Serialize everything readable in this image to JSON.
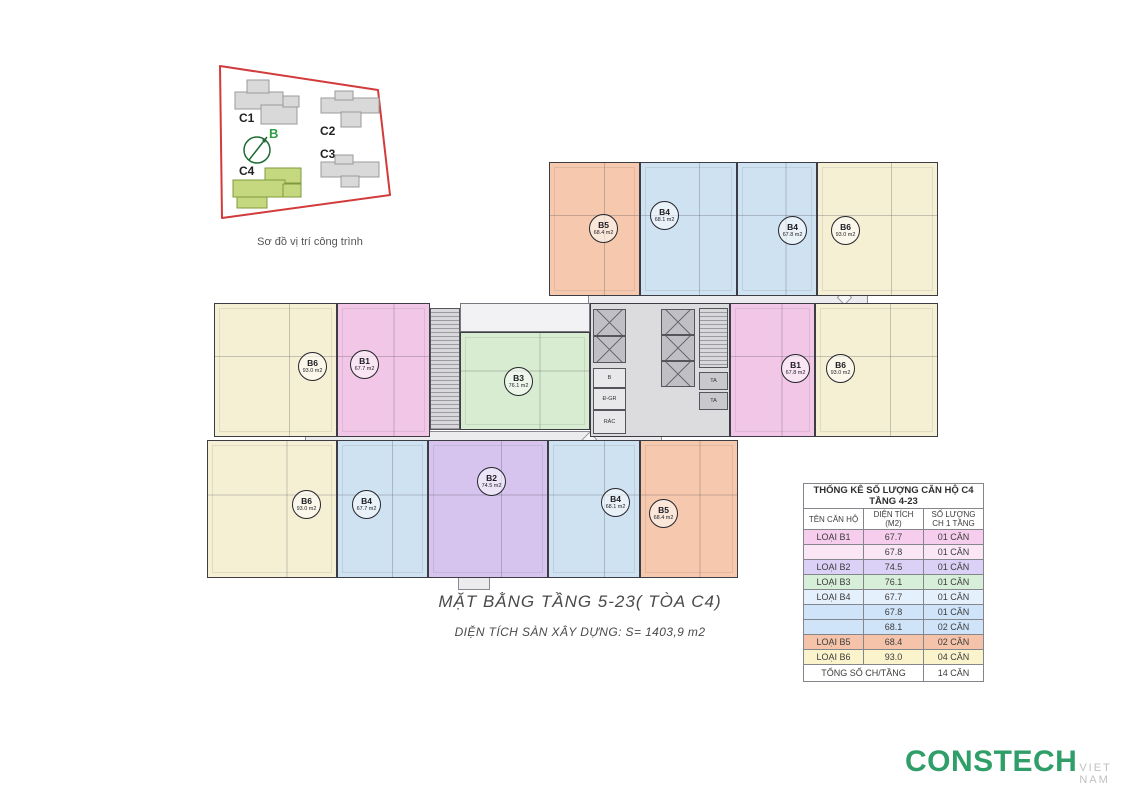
{
  "site_map": {
    "caption": "Sơ đồ vị trí công trình",
    "compass_label": "B",
    "boundary_color": "#d23b3b",
    "highlight_color": "#c6d87f",
    "buildings": [
      {
        "label": "C1",
        "highlighted": false
      },
      {
        "label": "C2",
        "highlighted": false
      },
      {
        "label": "C3",
        "highlighted": false
      },
      {
        "label": "C4",
        "highlighted": true
      }
    ]
  },
  "floor_plan": {
    "unit_colors": {
      "b1": "#f2c6e6",
      "b2": "#d6c4ee",
      "b3": "#d7ecd0",
      "b4": "#cfe2f2",
      "b5": "#f6c8ad",
      "b6": "#f5efd3"
    },
    "units": [
      {
        "label": "B5",
        "area": "68.4 m2",
        "type": "b5"
      },
      {
        "label": "B4",
        "area": "68.1 m2",
        "type": "b4"
      },
      {
        "label": "B4",
        "area": "67.8 m2",
        "type": "b4"
      },
      {
        "label": "B6",
        "area": "93.0 m2",
        "type": "b6"
      },
      {
        "label": "B6",
        "area": "93.0 m2",
        "type": "b6"
      },
      {
        "label": "B1",
        "area": "67.7 m2",
        "type": "b1"
      },
      {
        "label": "B3",
        "area": "76.1 m2",
        "type": "b3"
      },
      {
        "label": "B1",
        "area": "67.8 m2",
        "type": "b1"
      },
      {
        "label": "B6",
        "area": "93.0 m2",
        "type": "b6"
      },
      {
        "label": "B6",
        "area": "93.0 m2",
        "type": "b6"
      },
      {
        "label": "B4",
        "area": "67.7 m2",
        "type": "b4"
      },
      {
        "label": "B2",
        "area": "74.5 m2",
        "type": "b2"
      },
      {
        "label": "B4",
        "area": "68.1 m2",
        "type": "b4"
      },
      {
        "label": "B5",
        "area": "68.4 m2",
        "type": "b5"
      }
    ],
    "core_rooms": [
      "B",
      "Đ-GR",
      "RÁC"
    ],
    "shaft_label": "TA"
  },
  "title_block": {
    "title": "MẶT BẰNG TẦNG 5-23( TÒA C4)",
    "subtitle": "DIỆN TÍCH SÀN XÂY DỰNG: S= 1403,9 m2"
  },
  "stats_table": {
    "title": "THỐNG KÊ SỐ LƯỢNG CĂN HỘ C4 TẦNG 4-23",
    "headers": [
      "TÊN CĂN HỘ",
      "DIỆN TÍCH (M2)",
      "SỐ LƯỢNG CH 1 TẦNG"
    ],
    "rows": [
      {
        "name": "LOẠI B1",
        "area": "67.7",
        "count": "01 CĂN",
        "color": "#f6cdec"
      },
      {
        "name": "",
        "area": "67.8",
        "count": "01 CĂN",
        "color": "#fae6f5"
      },
      {
        "name": "LOẠI B2",
        "area": "74.5",
        "count": "01 CĂN",
        "color": "#dbd0f5"
      },
      {
        "name": "LOẠI B3",
        "area": "76.1",
        "count": "01 CĂN",
        "color": "#d7efd9"
      },
      {
        "name": "LOẠI B4",
        "area": "67.7",
        "count": "01 CĂN",
        "color": "#e4f0fc"
      },
      {
        "name": "",
        "area": "67.8",
        "count": "01 CĂN",
        "color": "#cfe4f9"
      },
      {
        "name": "",
        "area": "68.1",
        "count": "02 CĂN",
        "color": "#cfe4f9"
      },
      {
        "name": "LOẠI B5",
        "area": "68.4",
        "count": "02 CĂN",
        "color": "#f5c3a9"
      },
      {
        "name": "LOẠI B6",
        "area": "93.0",
        "count": "04 CĂN",
        "color": "#faf3cb"
      }
    ],
    "total_label": "TỔNG SỐ CH/TẦNG",
    "total_value": "14 CĂN"
  },
  "logo": {
    "name": "CONSTECH",
    "suffix": "VIET NAM",
    "color": "#2f9e68"
  }
}
